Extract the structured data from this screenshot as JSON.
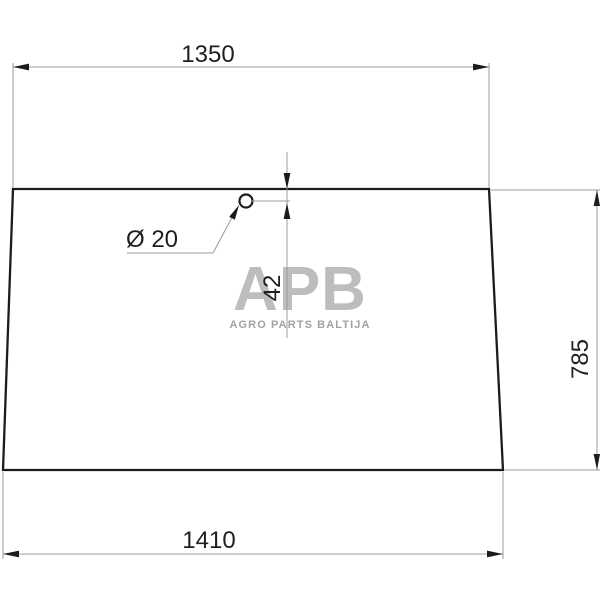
{
  "drawing": {
    "type": "technical-drawing",
    "part": "trapezoidal glass panel with one round mounting hole near top edge",
    "labels": {
      "top_width": "1350",
      "bottom_width": "1410",
      "height": "785",
      "hole_center_offset": "42",
      "hole_diameter": "Ø 20"
    }
  },
  "watermark": {
    "logo": "APB",
    "tagline": "AGRO PARTS BALTIJA"
  },
  "colors": {
    "background": "#ffffff",
    "outline": "#1c1c1c",
    "dimension_lines": "#9c9c9c",
    "dimension_text": "#1f1f1f",
    "watermark_logo": "#bdbdbd",
    "watermark_tagline": "#a2a2a2"
  }
}
